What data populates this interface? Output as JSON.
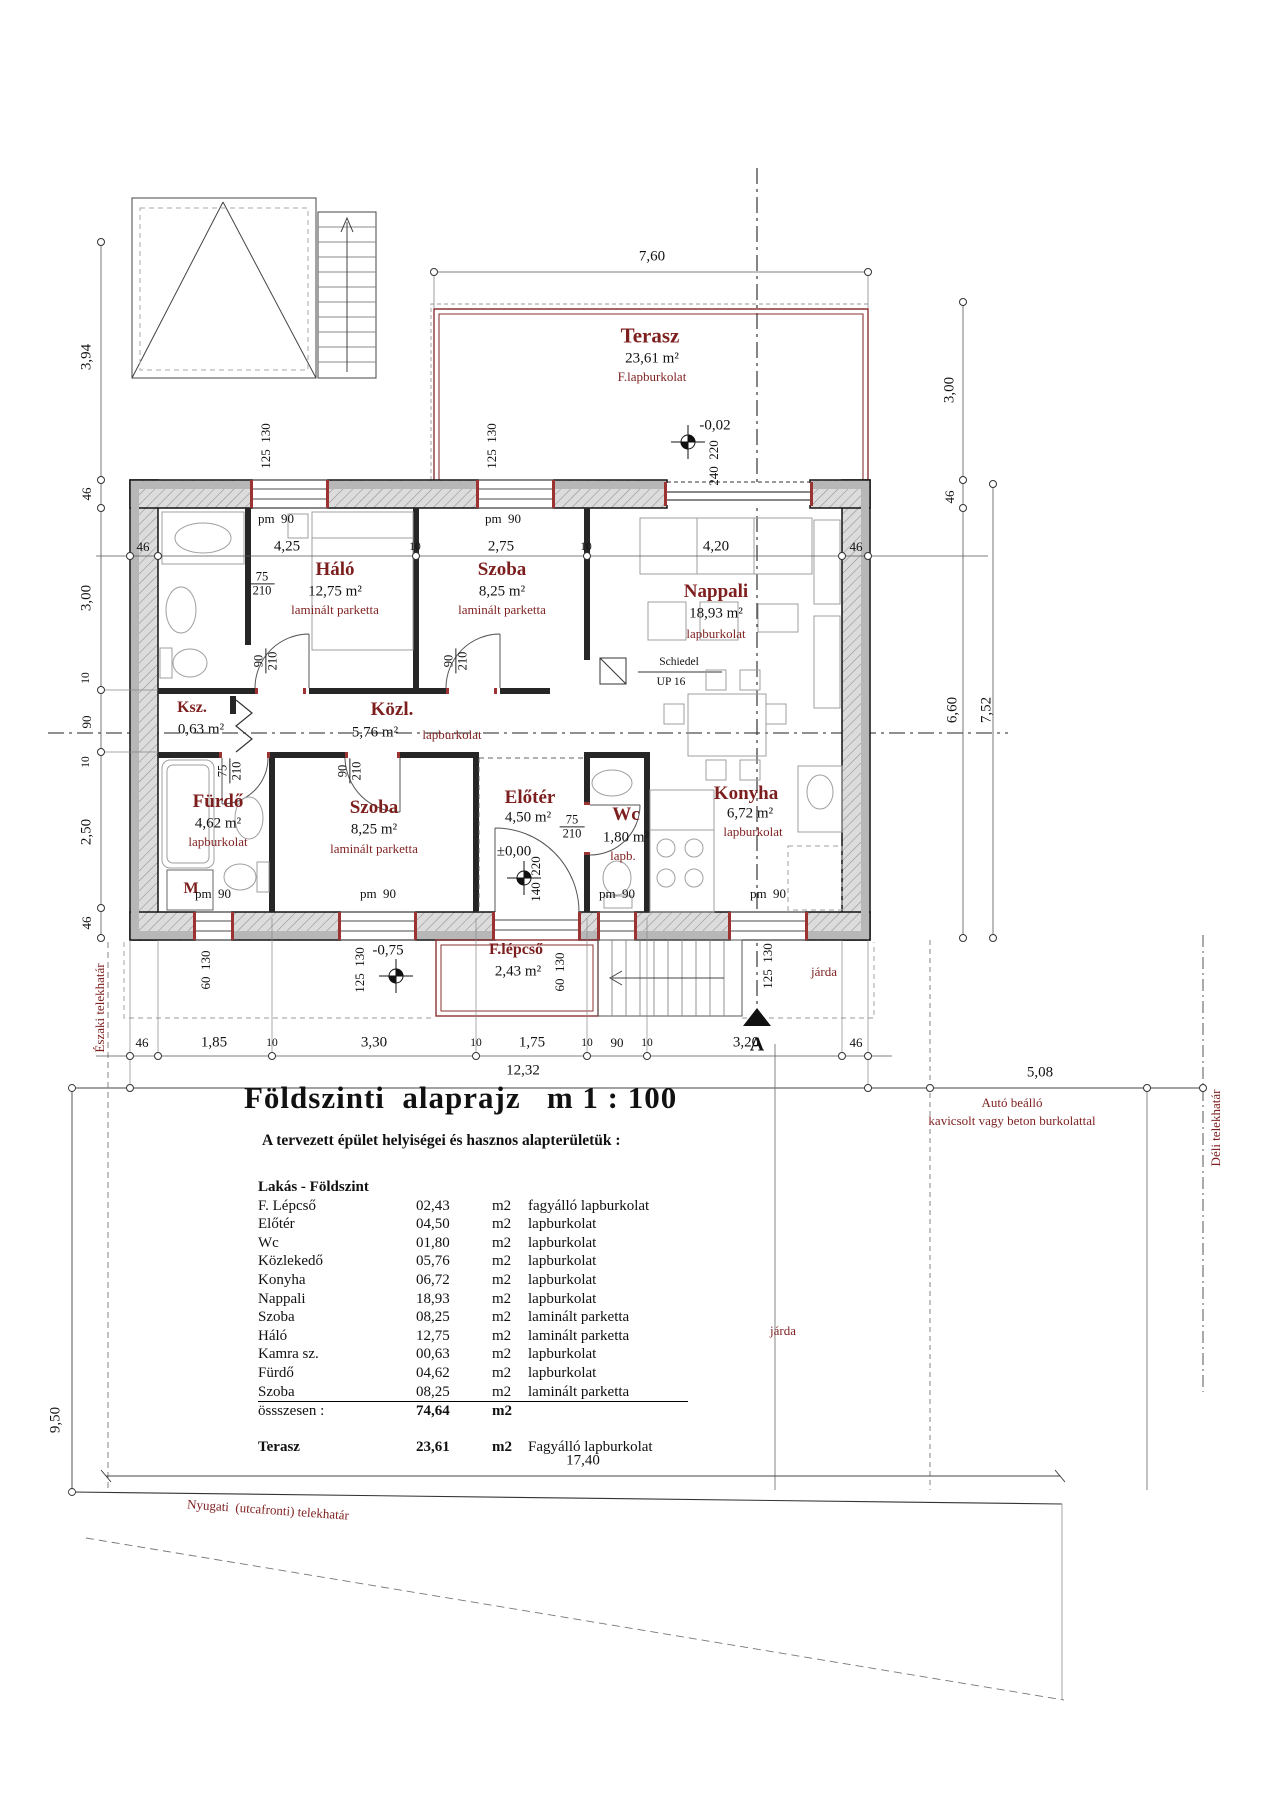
{
  "drawing": {
    "title": "Földszinti  alaprajz   m 1 : 100",
    "subtitle": "A tervezett épület helyiségei és hasznos alapterületük :",
    "group_header": "Lakás - Földszint",
    "rows": [
      {
        "name": "F. Lépcső",
        "value": "02,43",
        "unit": "m2",
        "finish": "fagyálló lapburkolat"
      },
      {
        "name": "Előtér",
        "value": "04,50",
        "unit": "m2",
        "finish": "lapburkolat"
      },
      {
        "name": "Wc",
        "value": "01,80",
        "unit": "m2",
        "finish": "lapburkolat"
      },
      {
        "name": "Közlekedő",
        "value": "05,76",
        "unit": "m2",
        "finish": "lapburkolat"
      },
      {
        "name": "Konyha",
        "value": "06,72",
        "unit": "m2",
        "finish": "lapburkolat"
      },
      {
        "name": "Nappali",
        "value": "18,93",
        "unit": "m2",
        "finish": "lapburkolat"
      },
      {
        "name": "Szoba",
        "value": "08,25",
        "unit": "m2",
        "finish": "laminált parketta"
      },
      {
        "name": "Háló",
        "value": "12,75",
        "unit": "m2",
        "finish": "laminált parketta"
      },
      {
        "name": "Kamra sz.",
        "value": "00,63",
        "unit": "m2",
        "finish": "lapburkolat"
      },
      {
        "name": "Fürdő",
        "value": "04,62",
        "unit": "m2",
        "finish": "lapburkolat"
      },
      {
        "name": "Szoba",
        "value": "08,25",
        "unit": "m2",
        "finish": "laminált parketta"
      }
    ],
    "total": {
      "name": "össszesen :",
      "value": "74,64",
      "unit": "m2"
    },
    "terrace_row": {
      "name": "Terasz",
      "value": "23,61",
      "unit": "m2",
      "finish": "Fagyálló lapburkolat"
    }
  },
  "rooms": {
    "terasz": {
      "name": "Terasz",
      "area": "23,61 m²",
      "finish": "F.lapburkolat"
    },
    "halo": {
      "name": "Háló",
      "area": "12,75 m²",
      "finish": "laminált parketta"
    },
    "szoba1": {
      "name": "Szoba",
      "area": "8,25 m²",
      "finish": "laminált parketta"
    },
    "nappali": {
      "name": "Nappali",
      "area": "18,93 m²",
      "finish": "lapburkolat"
    },
    "kozl": {
      "name": "Közl.",
      "area": "5,76 m²",
      "finish": "lapburkolat"
    },
    "ksz": {
      "name": "Ksz.",
      "area": "0,63 m²"
    },
    "furdo": {
      "name": "Fürdő",
      "area": "4,62 m²",
      "finish": "lapburkolat"
    },
    "szoba2": {
      "name": "Szoba",
      "area": "8,25 m²",
      "finish": "laminált parketta"
    },
    "eloter": {
      "name": "Előtér",
      "area": "4,50 m²"
    },
    "wc": {
      "name": "Wc",
      "area": "1,80 m²",
      "finish": "lapb."
    },
    "konyha": {
      "name": "Konyha",
      "area": "6,72 m²",
      "finish": "lapburkolat"
    },
    "flepcso": {
      "name": "F.lépcső",
      "area": "2,43 m²"
    }
  },
  "levels": {
    "terrace": "-0,02",
    "entry": "±0,00",
    "garden": "-0,75"
  },
  "annotations": {
    "chimney1": "Schiedel",
    "chimney2": "UP 16",
    "washer": "M",
    "section": "A"
  },
  "dims": {
    "terasz_width": "7,60",
    "left": [
      "3,94",
      "46",
      "3,00",
      "10",
      "90",
      "10",
      "2,50",
      "46"
    ],
    "right": [
      "3,00",
      "46",
      "6,60",
      "7,52"
    ],
    "top": [
      "46",
      "4,25",
      "10",
      "2,75",
      "10",
      "4,20",
      "46"
    ],
    "bottom": [
      "46",
      "1,85",
      "10",
      "3,30",
      "10",
      "1,75",
      "10",
      "90",
      "10",
      "3,20",
      "46"
    ],
    "total_width": "12,32",
    "side_width": "5,08",
    "front_width": "17,40",
    "depth": "9,50",
    "win_125": "125  130",
    "win_60": "60  130",
    "door_240": "240  220",
    "door_140": "140  220",
    "parapet": "pm  90",
    "door75": "75",
    "door90": "90",
    "h210": "210"
  },
  "site": {
    "north": "Északi telekhatár",
    "south": "Déli telekhatár",
    "west": "Nyugati  (utcafronti) telekhatár",
    "carport1": "Autó beálló",
    "carport2": "kavicsolt vagy beton burkolattal",
    "sidewalk": "járda"
  }
}
